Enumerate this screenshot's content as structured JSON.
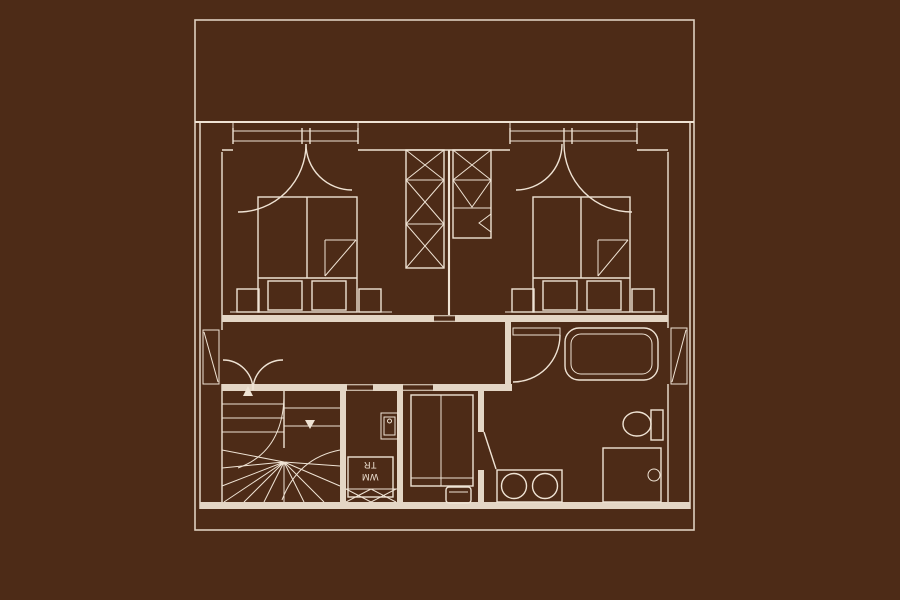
{
  "plan": {
    "labels": {
      "washing_machine": "WM",
      "dryer": "TR"
    }
  },
  "colors": {
    "background": "#4d2b17",
    "line": "#efe3d4",
    "wall_fill": "#e4d6c5",
    "boundary": "#decfbf"
  }
}
